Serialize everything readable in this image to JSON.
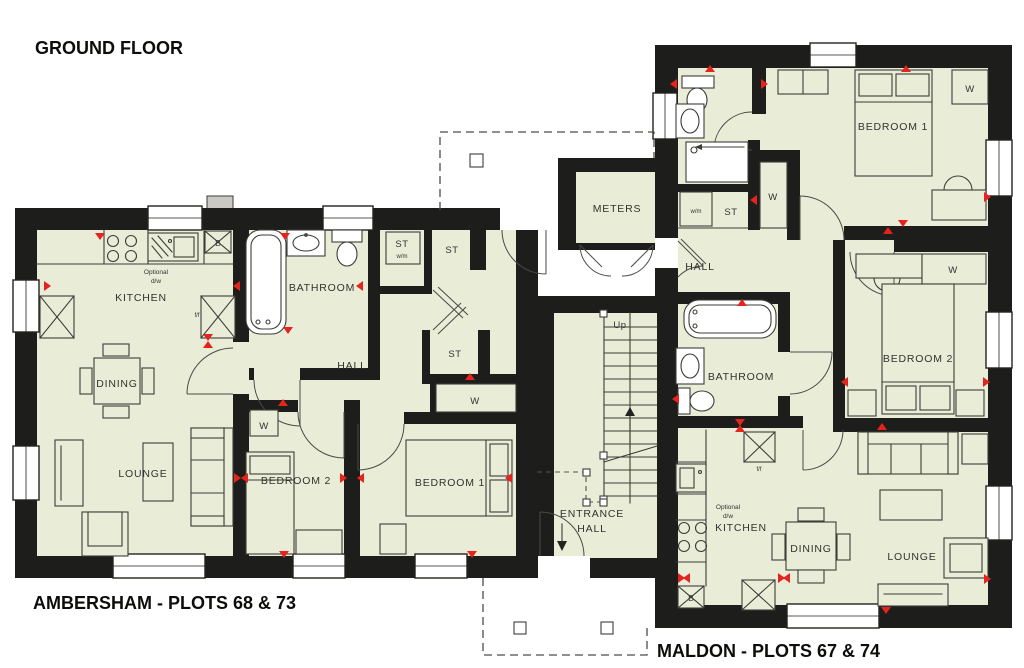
{
  "title": "GROUND FLOOR",
  "ambersham": {
    "name": "AMBERSHAM - PLOTS 68 & 73",
    "rooms": {
      "kitchen": "KITCHEN",
      "dining": "DINING",
      "lounge": "LOUNGE",
      "bathroom": "BATHROOM",
      "hall": "HALL",
      "bedroom1": "BEDROOM 1",
      "bedroom2": "BEDROOM 2"
    },
    "labels": {
      "store": "ST",
      "washing_machine": "w/m",
      "wardrobe": "W",
      "optional": "Optional",
      "dishwasher": "d/w",
      "boiler": "B",
      "fridge_freezer": "f/f"
    }
  },
  "maldon": {
    "name": "MALDON - PLOTS 67 & 74",
    "rooms": {
      "kitchen": "KITCHEN",
      "dining": "DINING",
      "lounge": "LOUNGE",
      "bathroom": "BATHROOM",
      "hall": "HALL",
      "bedroom1": "BEDROOM 1",
      "bedroom2": "BEDROOM 2"
    },
    "labels": {
      "store": "ST",
      "washing_machine": "w/m",
      "wardrobe": "W",
      "optional": "Optional",
      "dishwasher": "d/w",
      "boiler": "B",
      "fridge_freezer": "f/f"
    }
  },
  "communal": {
    "meters": "METERS",
    "entrance_line1": "ENTRANCE",
    "entrance_line2": "HALL",
    "stairs_up": "Up"
  },
  "colors": {
    "wall": "#1d1d1b",
    "floor": "#e9edd8",
    "line": "#3c3c38",
    "red": "#e5241f",
    "paper": "#ffffff"
  }
}
